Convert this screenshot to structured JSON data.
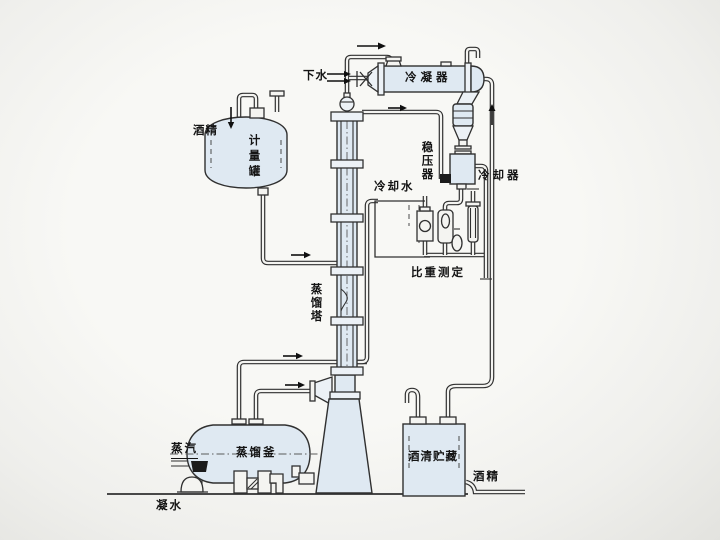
{
  "diagram": {
    "type": "process-flow-diagram",
    "subject": "alcohol distillation system",
    "labels": {
      "drain_water": "下水",
      "condenser": "冷凝器",
      "alcohol_feed": "酒精",
      "metering_tank": "计量罐",
      "pressure_stabilizer": "稳压器",
      "cooling_water": "冷却水",
      "cooler": "冷却器",
      "specific_gravity_measurement": "比重测定",
      "distillation_tower": "蒸馏塔",
      "distillation_kettle": "蒸馏釜",
      "steam": "蒸汽",
      "alcohol_storage": "酒清贮藏",
      "alcohol_out": "酒精",
      "condensate_water": "凝水"
    },
    "icons": {
      "flow-arrow": "▶",
      "double-flow-arrow": "⇒"
    },
    "colors": {
      "line": "#303030",
      "vessel_fill": "#dfe9f2",
      "paper": "#f4f4f1",
      "valve_black": "#1b1b1b"
    }
  }
}
